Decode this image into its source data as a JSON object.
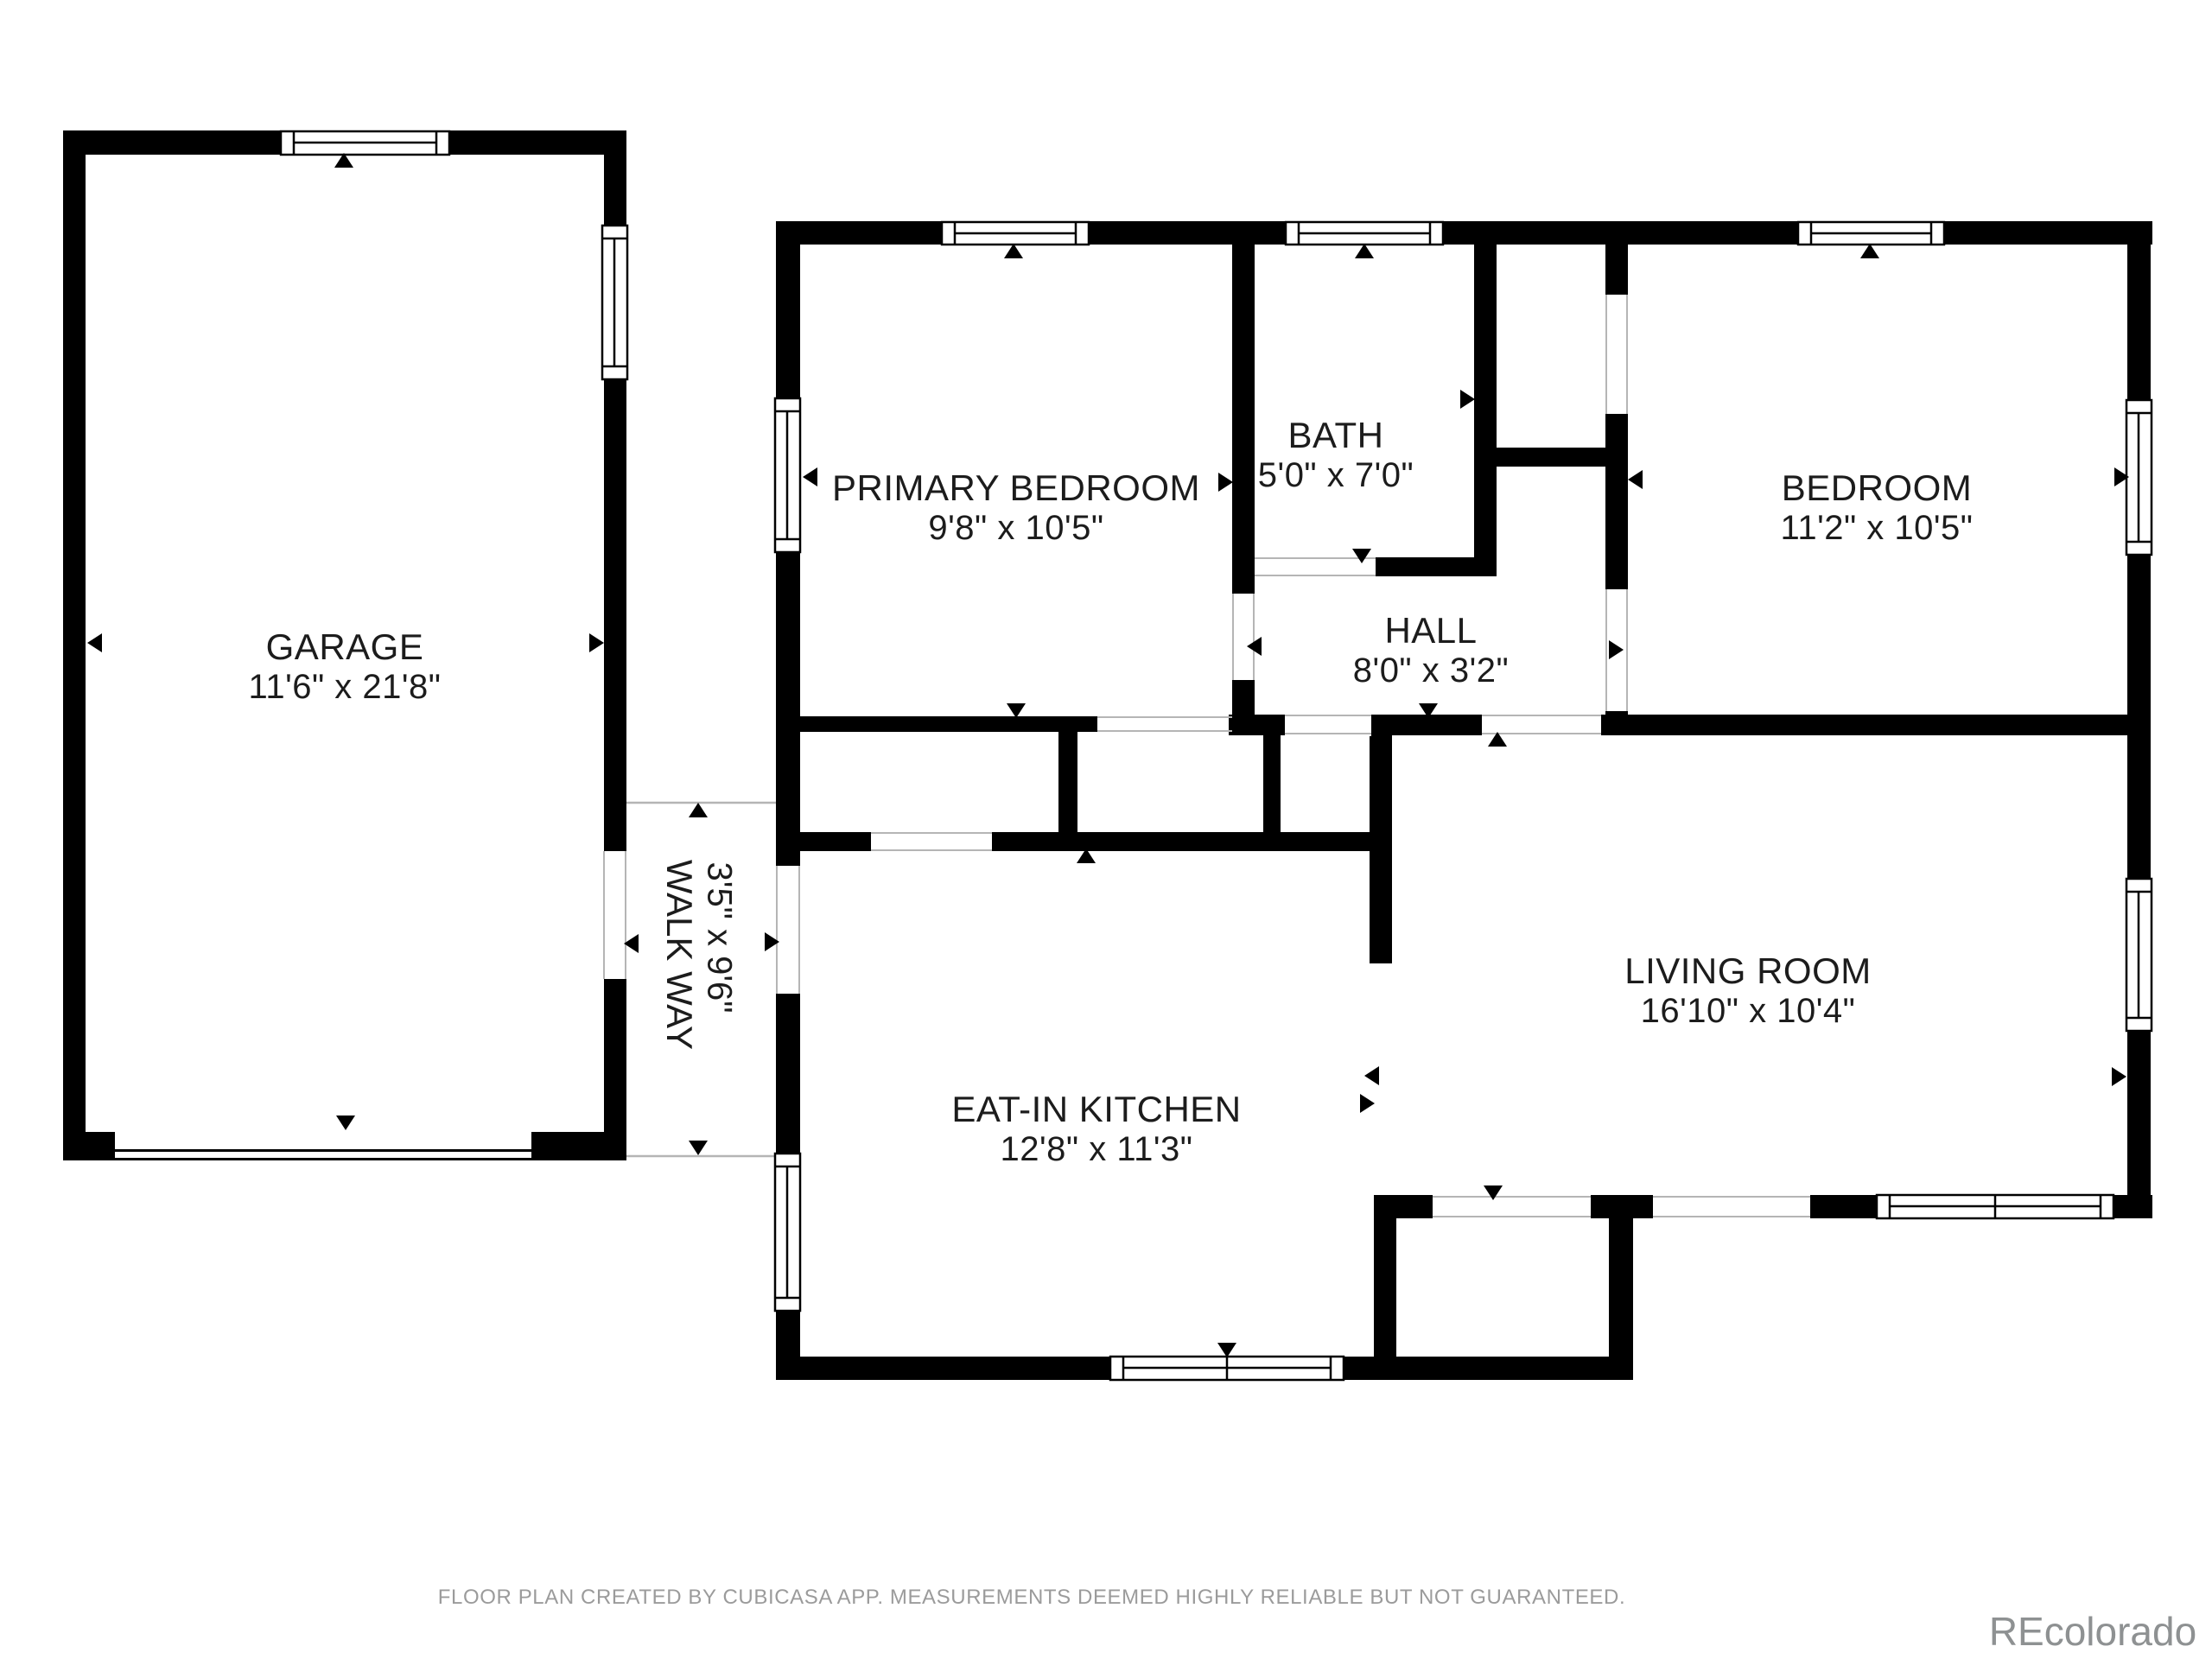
{
  "rooms": [
    {
      "id": "garage",
      "name": "GARAGE",
      "dimensions": "11'6\" x 21'8\""
    },
    {
      "id": "walkway",
      "name": "WALK WAY",
      "dimensions": "3'5\" x 9'6\""
    },
    {
      "id": "primary-bedroom",
      "name": "PRIMARY BEDROOM",
      "dimensions": "9'8\" x 10'5\""
    },
    {
      "id": "bath",
      "name": "BATH",
      "dimensions": "5'0\" x 7'0\""
    },
    {
      "id": "hall",
      "name": "HALL",
      "dimensions": "8'0\" x 3'2\""
    },
    {
      "id": "bedroom",
      "name": "BEDROOM",
      "dimensions": "11'2\" x 10'5\""
    },
    {
      "id": "eat-in-kitchen",
      "name": "EAT-IN KITCHEN",
      "dimensions": "12'8\" x 11'3\""
    },
    {
      "id": "living-room",
      "name": "LIVING ROOM",
      "dimensions": "16'10\" x 10'4\""
    }
  ],
  "footer": {
    "disclaimer": "FLOOR PLAN CREATED BY CUBICASA APP. MEASUREMENTS DEEMED HIGHLY RELIABLE BUT NOT GUARANTEED."
  },
  "watermark": {
    "text": "REcolorado"
  },
  "colors": {
    "wall": "#000000",
    "label_text": "#1c1c1c",
    "muted_text": "#9b9b9b",
    "watermark_text": "#8e9192",
    "background": "#ffffff"
  }
}
